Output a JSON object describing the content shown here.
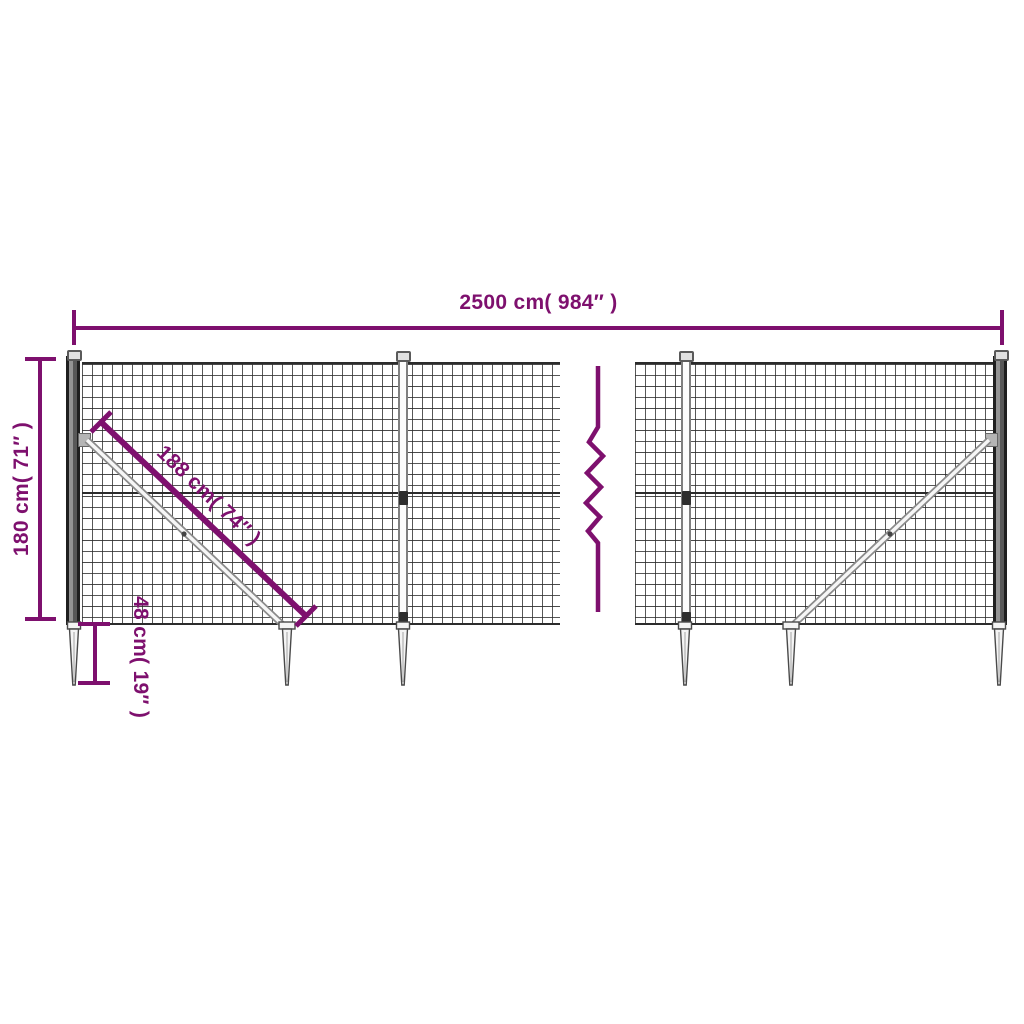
{
  "diagram": {
    "subject": "wire-mesh-fence-with-spike-anchors-dimension-diagram",
    "background": "#ffffff",
    "accent_color": "#7e106e",
    "mesh_line_color": "#2d2d2d",
    "metal_outline_color": "#4a4a4a",
    "metal_fill_color": "#f4f4f4",
    "labels": {
      "total_width": "2500 cm( 984″ )",
      "fence_height": "180 cm( 71″ )",
      "brace_length": "188 cm( 74″ )",
      "spike_depth": "48 cm( 19″ )"
    },
    "counts": {
      "panels": 2,
      "ground_spikes": 6,
      "diagonal_braces": 2
    }
  }
}
